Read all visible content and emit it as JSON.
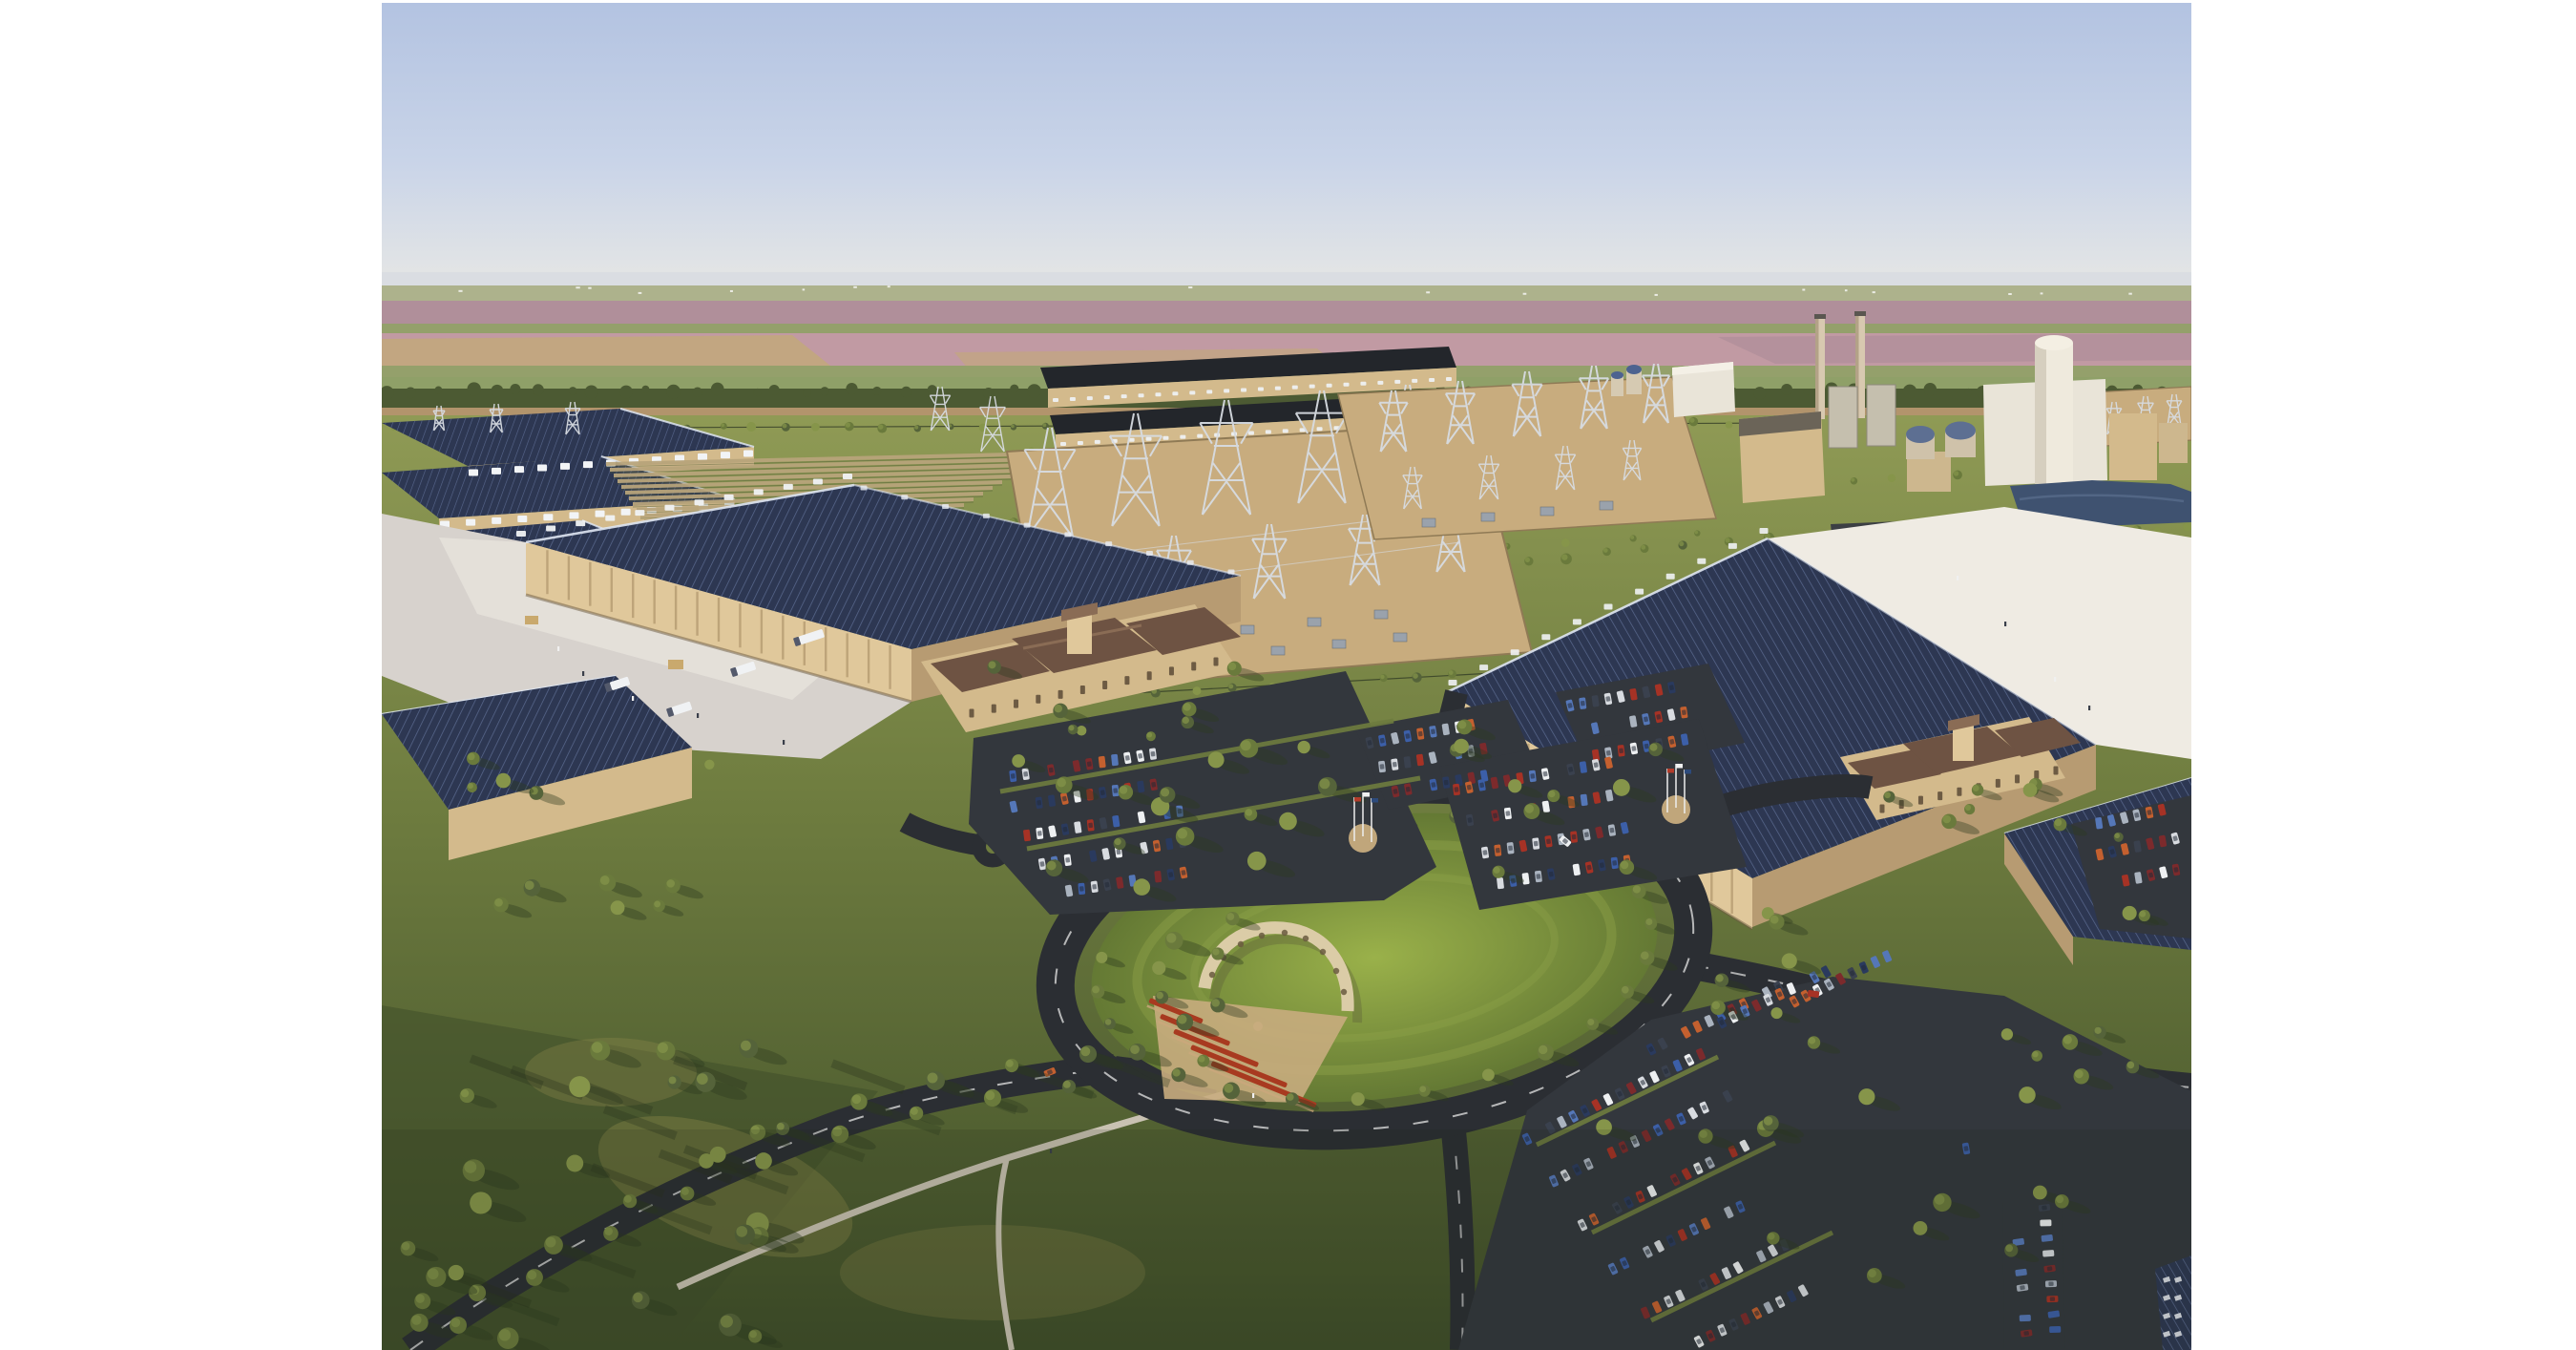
{
  "meta": {
    "title": "Aerial rendering of a large industrial campus surrounded by farmland",
    "description": "Photorealistic bird's-eye rendering: two huge manufacturing halls with rooftop solar arrays and Spanish-style entrance pavilions, electrical substations with lattice towers, a gas power plant with two exhaust stacks, a ground solar array, a central oval park with an arched colonnade monument and terraced red flower beds, tree-lined roads, walking paths and parking lots full of cars. Late-day sun casts long shadows. Pink and tan farm fields stretch to a hazy horizon under a clear pale-blue sky. White letterbox margins on the left and right edges."
  },
  "palette": {
    "white_margin": "#ffffff",
    "sky_top": "#b3c3e1",
    "sky_mid": "#c9d4e8",
    "sky_horizon": "#e0e3e6",
    "haze": "#d8dce1",
    "field_pale": "#adb28c",
    "field_mauve": "#b08f9a",
    "field_pink": "#c19aa3",
    "field_tan": "#c2a77d",
    "field_green": "#94a06b",
    "treeline": "#4c5a33",
    "dirt_road": "#b2946c",
    "grass_light": "#8f9a55",
    "grass_mid": "#6e7c3f",
    "grass_dark": "#3f4e29",
    "meadow_gold": "#968e4e",
    "lawn_light": "#9ab14a",
    "lawn_dark": "#647934",
    "solar_roof": "#2d3752",
    "solar_stripe": "#6b7ca6",
    "solar_glint": "#dfe6f2",
    "dark_roof": "#23262b",
    "wall_lit": "#e0c89b",
    "wall_tan": "#d3ba8c",
    "wall_shadow": "#b79b72",
    "pilaster": "#b2986e",
    "concrete_yard": "#d7d2cd",
    "yard_bright": "#efebe3",
    "asphalt": "#33373d",
    "road_dark": "#2b2e33",
    "lane_mark": "#d9d9d9",
    "path_gray": "#c9c2b2",
    "entrance_roof": "#6e5343",
    "roof_ridge": "#8a6c55",
    "arch_stone": "#dbcca7",
    "flower_red": "#a83a20",
    "gravel_tan": "#c8ac7e",
    "pond_blue": "#3f5270",
    "stack_tan": "#d8c9b0",
    "plant_cream": "#e9e4d8",
    "tower_gray": "#d7dbe1",
    "trailer_white": "#f0f2f4",
    "tree_dark": "#55633a",
    "tree_mid": "#6a7a3c",
    "tree_light": "#86954a",
    "shadow_green": "#2c3a20",
    "dome_blue": "#4d6390",
    "equipment_gray": "#9aa2ac"
  },
  "scene": {
    "setting": "aerial oblique view, late-afternoon light with long eastward shadows",
    "sky": {
      "condition": "clear gradient sky",
      "colors": [
        "sky_top",
        "sky_horizon"
      ]
    },
    "background": {
      "farmland_bands": [
        "field_pale",
        "field_mauve",
        "field_pink",
        "field_tan",
        "field_green"
      ],
      "horizon_haze": true,
      "distant_farm_buildings": "tiny white specks along the horizon",
      "dark_treeline_and_dirt_road": true
    },
    "campus": {
      "buildings": [
        {
          "name": "manufacturing-hall-west",
          "roof": "blue rooftop solar panels",
          "walls": "tan precast with pilasters",
          "features": [
            "white concrete loading yard",
            "dock trailers",
            "Spanish-style entrance pavilion with brown tile roof"
          ]
        },
        {
          "name": "manufacturing-hall-east",
          "roof": "blue rooftop solar panels",
          "walls": "tan precast with pilasters",
          "features": [
            "bright white service yard",
            "Spanish-style entrance pavilion with brown tile roof"
          ]
        },
        {
          "name": "rear-equipment-halls",
          "count": 3,
          "features": [
            "solar roofs",
            "rows of white rooftop units"
          ]
        },
        {
          "name": "long-utility-halls",
          "count": 2,
          "features": [
            "dark roofs",
            "rows of white equipment"
          ]
        },
        {
          "name": "southeast-hall",
          "roof": "solar panels"
        },
        {
          "name": "corner-hall",
          "roof": "solar panels with white skylights"
        },
        {
          "name": "gas-power-plant",
          "features": [
            "two tall exhaust stacks",
            "cylindrical tower building",
            "dome storage tanks",
            "white tanker trailers"
          ]
        },
        {
          "name": "water-tanks",
          "count": 2,
          "dome_color": "dome_blue"
        },
        {
          "name": "white-admin-building"
        }
      ],
      "infrastructure": [
        {
          "name": "substation-main",
          "features": [
            "tan gravel pad",
            "lattice towers",
            "transformers"
          ]
        },
        {
          "name": "substation-north"
        },
        {
          "name": "substation-northeast"
        },
        {
          "name": "ground-solar-array",
          "rows": 12
        },
        {
          "name": "transmission-towers"
        }
      ],
      "landscape": [
        {
          "name": "central-oval-park",
          "features": [
            "oval ring road with dashed lane lines",
            "ring of trees",
            "arched colonnade monument",
            "terraced red flower beds",
            "gravel plaza"
          ]
        },
        {
          "name": "tree-lined-avenue"
        },
        {
          "name": "walking-paths"
        },
        {
          "name": "meadow-with-long-shadows"
        },
        {
          "name": "pond"
        }
      ],
      "parking": {
        "lots": 7,
        "car_colors": [
          "#a63225",
          "#c4602f",
          "#3c5fa8",
          "#2a3a5e",
          "#eef0f2",
          "#aab3bf",
          "#3a414e",
          "#7c2a2c",
          "#5577b8",
          "#d8dbe0"
        ]
      },
      "flags": {
        "plazas": 2,
        "poles_per_plaza": 3
      }
    }
  }
}
